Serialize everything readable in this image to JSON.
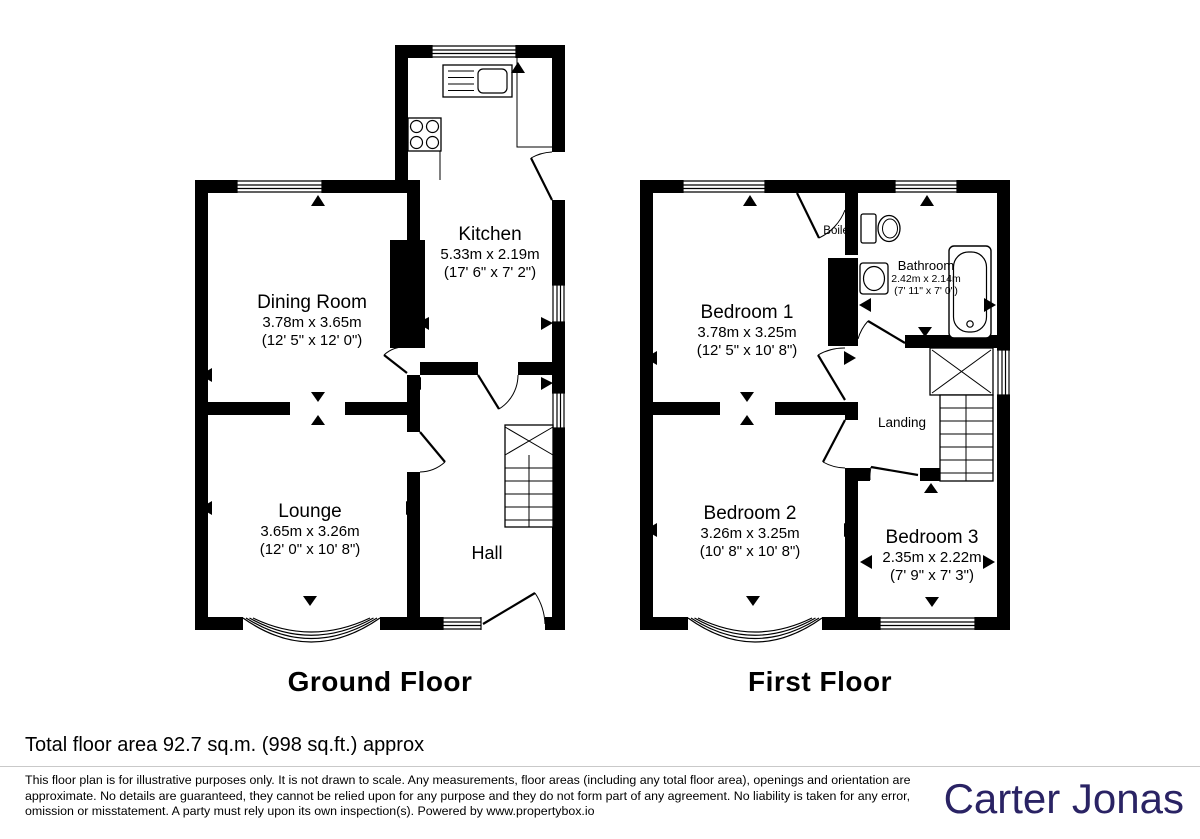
{
  "plan": {
    "ground_floor": {
      "title": "Ground Floor",
      "rooms": {
        "kitchen": {
          "name": "Kitchen",
          "metric": "5.33m x 2.19m",
          "imperial": "(17' 6\" x 7' 2\")"
        },
        "dining_room": {
          "name": "Dining Room",
          "metric": "3.78m x 3.65m",
          "imperial": "(12' 5\" x 12' 0\")"
        },
        "lounge": {
          "name": "Lounge",
          "metric": "3.65m x 3.26m",
          "imperial": "(12' 0\" x 10' 8\")"
        },
        "hall": {
          "name": "Hall"
        }
      }
    },
    "first_floor": {
      "title": "First Floor",
      "rooms": {
        "bedroom1": {
          "name": "Bedroom 1",
          "metric": "3.78m x 3.25m",
          "imperial": "(12' 5\" x 10' 8\")"
        },
        "bedroom2": {
          "name": "Bedroom 2",
          "metric": "3.26m x 3.25m",
          "imperial": "(10' 8\" x 10' 8\")"
        },
        "bedroom3": {
          "name": "Bedroom 3",
          "metric": "2.35m x 2.22m",
          "imperial": "(7' 9\" x 7' 3\")"
        },
        "bathroom": {
          "name": "Bathroom",
          "metric": "2.42m x 2.14m",
          "imperial": "(7' 11\" x 7' 0\")"
        },
        "boiler": {
          "name": "Boiler"
        },
        "landing": {
          "name": "Landing"
        }
      }
    }
  },
  "footer": {
    "total_area": "Total floor area 92.7 sq.m. (998 sq.ft.) approx",
    "disclaimer": "This floor plan is for illustrative purposes only. It is not drawn to scale. Any measurements, floor areas (including any total floor area), openings and orientation are approximate. No details are guaranteed, they cannot be relied upon for any purpose and they do not form part of any agreement. No liability is taken for any error, omission or misstatement. A party must rely upon its own inspection(s). Powered by www.propertybox.io",
    "brand": "Carter Jonas",
    "brand_color": "#2a2364"
  }
}
